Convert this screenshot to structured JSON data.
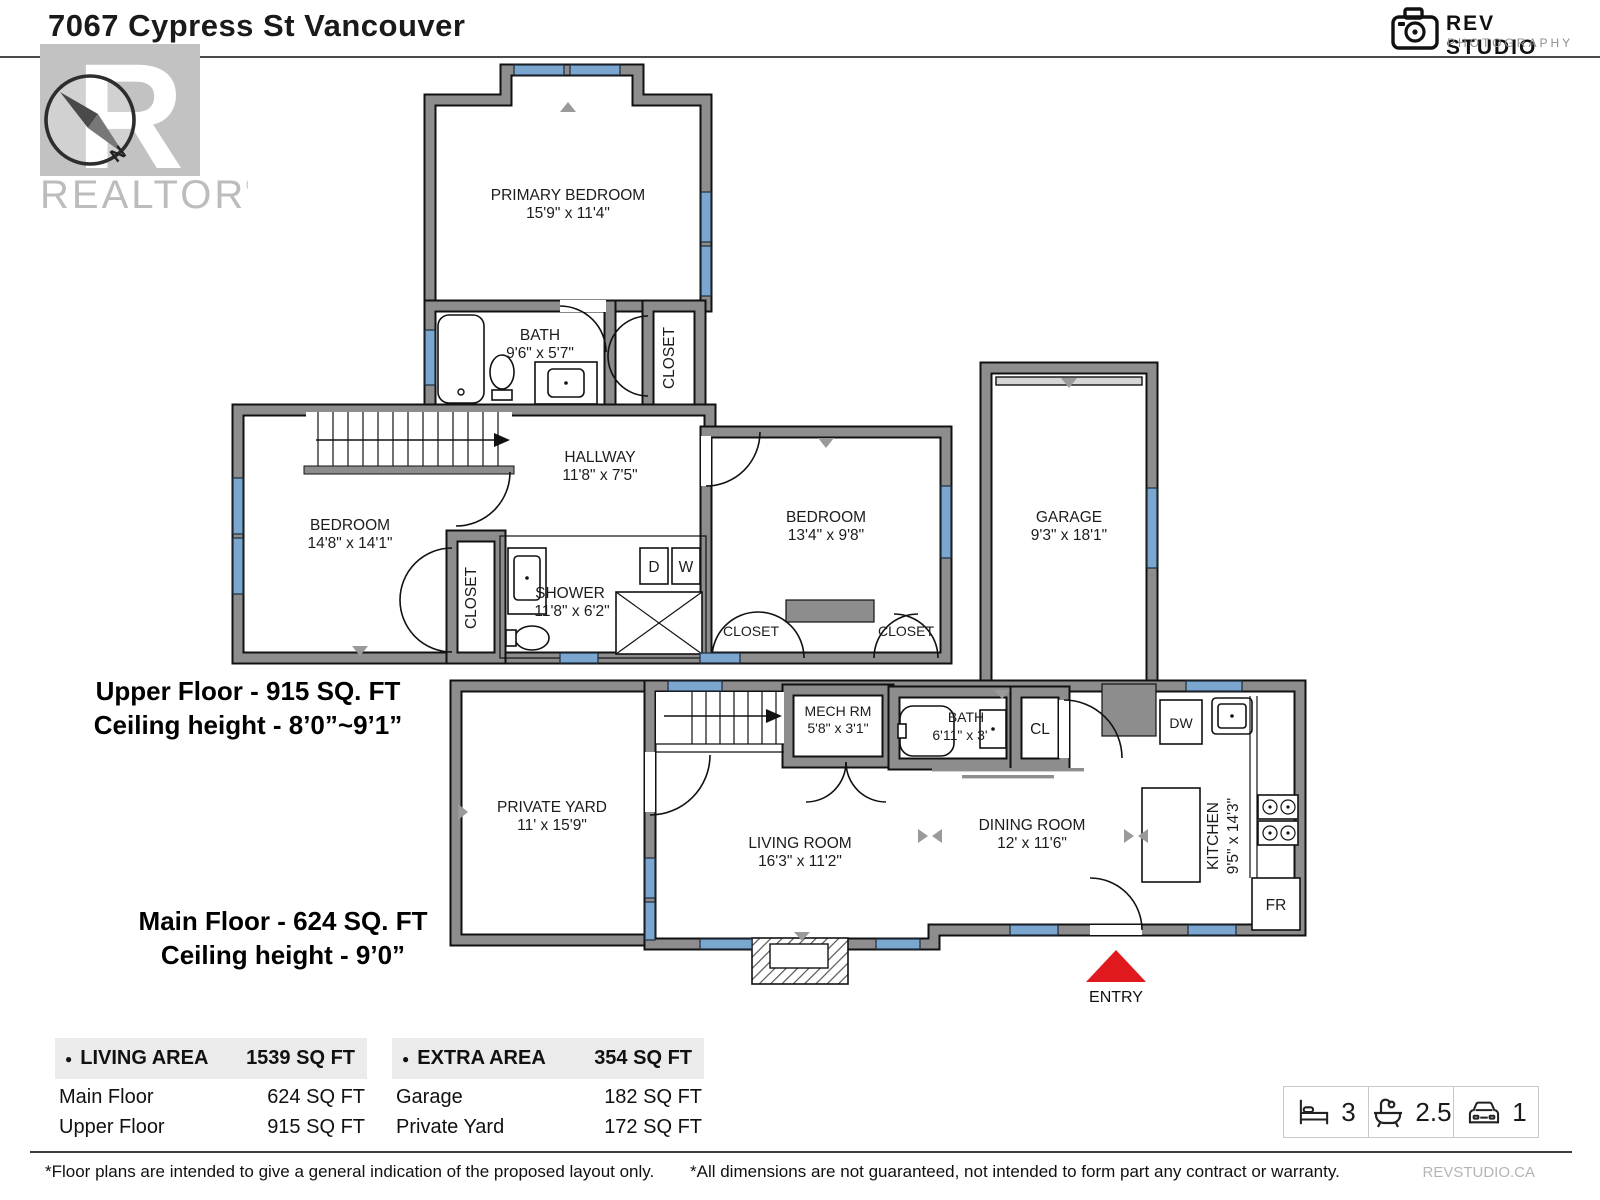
{
  "header": {
    "title": "7067 Cypress St Vancouver"
  },
  "logo": {
    "name": "REV STUDIO",
    "sub": "PHOTOGRAPHY"
  },
  "watermark": {
    "letter": "R",
    "realtor": "REALTOR",
    "reg": "®",
    "north": "N"
  },
  "upper_floor": {
    "summary_line1": "Upper Floor - 915 SQ. FT",
    "summary_line2": "Ceiling height - 8’0”~9’1”",
    "primary_bedroom": {
      "name": "PRIMARY BEDROOM",
      "dims": "15'9\" x 11'4\""
    },
    "bath": {
      "name": "BATH",
      "dims": "9'6\" x 5'7\""
    },
    "closet_top": "CLOSET",
    "hallway": {
      "name": "HALLWAY",
      "dims": "11'8\" x 7'5\""
    },
    "bedroom_left": {
      "name": "BEDROOM",
      "dims": "14'8\" x 14'1\""
    },
    "closet_left": "CLOSET",
    "shower": {
      "name": "SHOWER",
      "dims": "11'8\" x 6'2\""
    },
    "dryer": "D",
    "washer": "W",
    "bedroom_right": {
      "name": "BEDROOM",
      "dims": "13'4\" x 9'8\""
    },
    "closet_bottom_left": "CLOSET",
    "closet_bottom_right": "CLOSET",
    "garage": {
      "name": "GARAGE",
      "dims": "9'3\" x 18'1\""
    }
  },
  "main_floor": {
    "summary_line1": "Main Floor - 624 SQ. FT",
    "summary_line2": "Ceiling height - 9’0”",
    "private_yard": {
      "name": "PRIVATE YARD",
      "dims": "11' x 15'9\""
    },
    "mech_room": {
      "name": "MECH RM",
      "dims": "5'8\" x 3'1\""
    },
    "bath": {
      "name": "BATH",
      "dims": "6'11\" x 3'"
    },
    "closet": "CL",
    "living_room": {
      "name": "LIVING ROOM",
      "dims": "16'3\" x 11'2\""
    },
    "dining_room": {
      "name": "DINING ROOM",
      "dims": "12' x 11'6\""
    },
    "kitchen": {
      "name": "KITCHEN",
      "dims": "9'5\" x 14'3\""
    },
    "dishwasher": "DW",
    "fridge": "FR",
    "entry": "ENTRY"
  },
  "tables": {
    "living_area": {
      "bullet": "●",
      "header": "LIVING AREA",
      "total": "1539 SQ FT",
      "rows": [
        {
          "label": "Main Floor",
          "value": "624 SQ FT"
        },
        {
          "label": "Upper Floor",
          "value": "915 SQ FT"
        }
      ]
    },
    "extra_area": {
      "bullet": "●",
      "header": "EXTRA AREA",
      "total": "354 SQ FT",
      "rows": [
        {
          "label": "Garage",
          "value": "182 SQ FT"
        },
        {
          "label": "Private Yard",
          "value": "172 SQ FT"
        }
      ]
    }
  },
  "stats": {
    "beds": "3",
    "baths": "2.5",
    "parking": "1"
  },
  "footer": {
    "left": "*Floor plans are intended to give a general indication of the proposed layout only.",
    "right": "*All dimensions are not guaranteed, not intended to form part any contract or warranty.",
    "brand": "REVSTUDIO.CA"
  },
  "colors": {
    "wall_gray": "#8d8d8d",
    "window_blue": "#7ba6cf",
    "entry_red": "#e0191f"
  }
}
